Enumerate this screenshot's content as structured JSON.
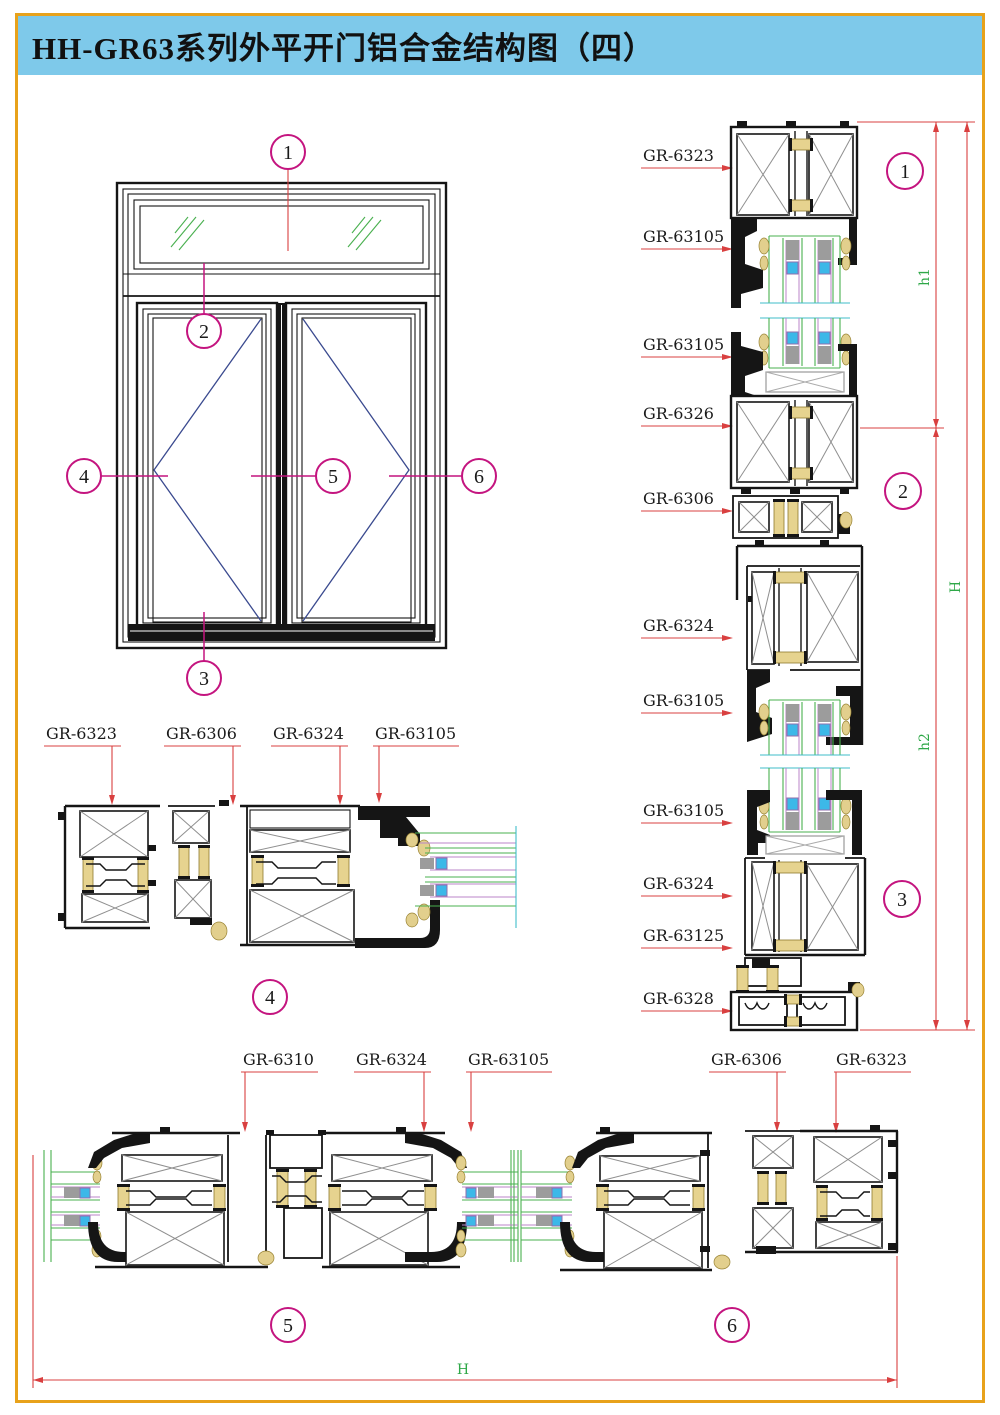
{
  "title": {
    "text": "HH-GR63系列外平开门铝合金结构图（四）"
  },
  "colors": {
    "title_bg": "#7ec9ea",
    "page_border": "#e8a21b",
    "callout_magenta": "#c4147f",
    "leader_red": "#d94040",
    "dim_green": "#2fa848",
    "profile_black": "#151515",
    "hatch_gray": "#8f8f8f",
    "thermal_break_tan": "#e6d38f",
    "glass_green": "#49b04f",
    "glass_purple": "#bb86c9",
    "glazing_cyan": "#3cb8e8",
    "spacer_gray": "#9c9c9c",
    "swing_line_navy": "#3a4a8f"
  },
  "elevation": {
    "callouts": [
      "1",
      "2",
      "3",
      "4",
      "5",
      "6"
    ]
  },
  "right_view": {
    "labels": [
      "GR-6323",
      "GR-63105",
      "GR-63105",
      "GR-6326",
      "GR-6306",
      "GR-6324",
      "GR-63105",
      "GR-63105",
      "GR-6324",
      "GR-63125",
      "GR-6328"
    ],
    "callouts": [
      "1",
      "2",
      "3"
    ],
    "dims": {
      "h1": "h1",
      "h2": "h2",
      "H": "H"
    }
  },
  "section4": {
    "labels": [
      "GR-6323",
      "GR-6306",
      "GR-6324",
      "GR-63105"
    ],
    "callout": "4"
  },
  "section5": {
    "labels": [
      "GR-6310",
      "GR-6324",
      "GR-63105"
    ],
    "callout": "5"
  },
  "section6": {
    "labels": [
      "GR-6306",
      "GR-6323"
    ],
    "callout": "6"
  },
  "bottom_dim": {
    "label": "H"
  }
}
